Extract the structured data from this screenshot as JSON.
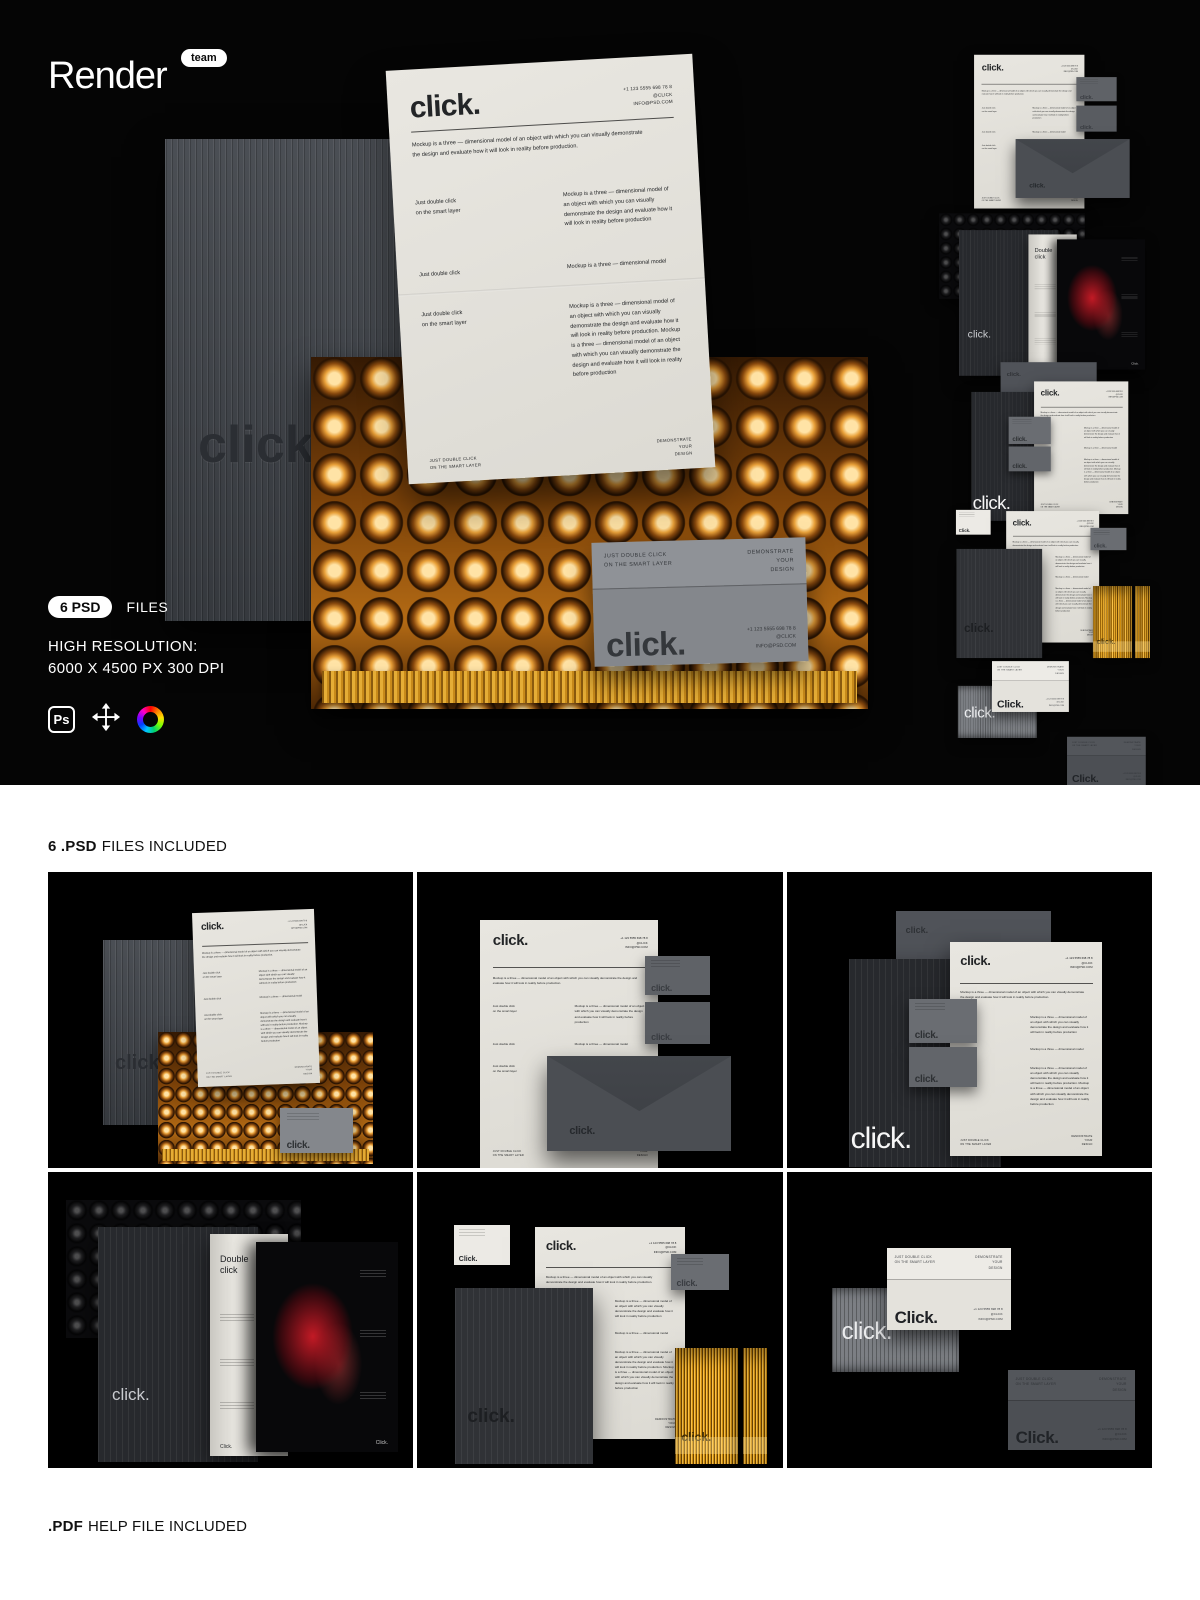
{
  "header": {
    "logo": "Render",
    "badge": "team"
  },
  "meta": {
    "pill": "6 PSD",
    "pill_suffix": "FILES",
    "res1": "HIGH RESOLUTION:",
    "res2": "6000 X 4500 PX 300 DPI",
    "ps": "Ps"
  },
  "brand": {
    "logo": "click.",
    "logo_cap": "Click.",
    "phone": "+1 123 5555 698 78 8",
    "handle": "@CLICK",
    "email": "INFO@PSD.COM",
    "intro": "Mockup is a three — dimensional model of an object with which you can visually demonstrate the design and evaluate how it will look in reality before production.",
    "para_full": "Mockup is a three — dimensional model of an object with which you can visually demonstrate the design and evaluate how it will look in reality before production",
    "para_short": "Mockup is a three — dimensional model",
    "para_double": "Mockup is a three — dimensional model of an object with which you can visually demonstrate the design and evaluate how it will look in reality before production. Mockup is a three — dimensional model of an object with which you can visually demonstrate the design and evaluate how it will look in reality before production",
    "hint1": "Just double click",
    "hint2": "on the smart layer",
    "hint_caps1": "JUST DOUBLE CLICK",
    "hint_caps2": "ON THE SMART LAYER",
    "demo1": "DEMONSTRATE",
    "demo2": "YOUR",
    "demo3": "DESIGN",
    "mag1": "Double",
    "mag2": "click"
  },
  "sections": {
    "grid_title_bold": "6 .PSD",
    "grid_title_rest": "FILES INCLUDED",
    "footer_bold": ".PDF",
    "footer_rest": "HELP FILE INCLUDED"
  },
  "colors": {
    "bg_black": "#050505",
    "paper": "#e3e1db",
    "accent_gold": "#c8841a",
    "card_gray": "#85878c"
  }
}
